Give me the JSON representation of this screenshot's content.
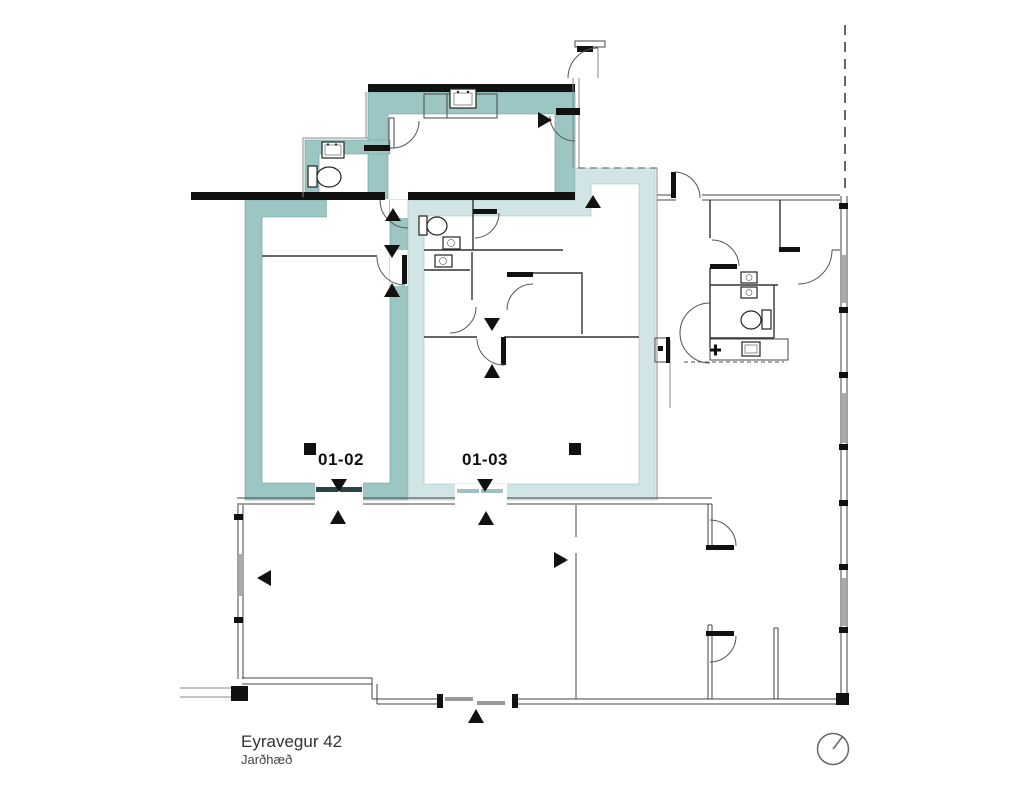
{
  "plan": {
    "address": "Eyravegur 42",
    "floor_label": "Jarðhæð",
    "units": [
      {
        "id": "01-02",
        "label": "01-02",
        "highlight_color": "#9cc6c3"
      },
      {
        "id": "01-03",
        "label": "01-03",
        "highlight_color": "#d2e5e6"
      }
    ]
  },
  "colors": {
    "background": "#ffffff",
    "wall": "#111111",
    "thin_line": "#444444",
    "window_fill": "#aaaaaa",
    "unit_0102_highlight": "#9cc6c3",
    "unit_0103_highlight": "#d2e5e6",
    "door_panel_dark": "#28454a",
    "door_panel_light": "#9fc0c2",
    "text": "#333333"
  },
  "icons": {
    "north_indicator": "compass-circle",
    "direction_marker": "black-triangle",
    "unit_entry_marker": "black-square",
    "toilet": "toilet-plan-symbol",
    "sink": "sink-plan-symbol"
  }
}
